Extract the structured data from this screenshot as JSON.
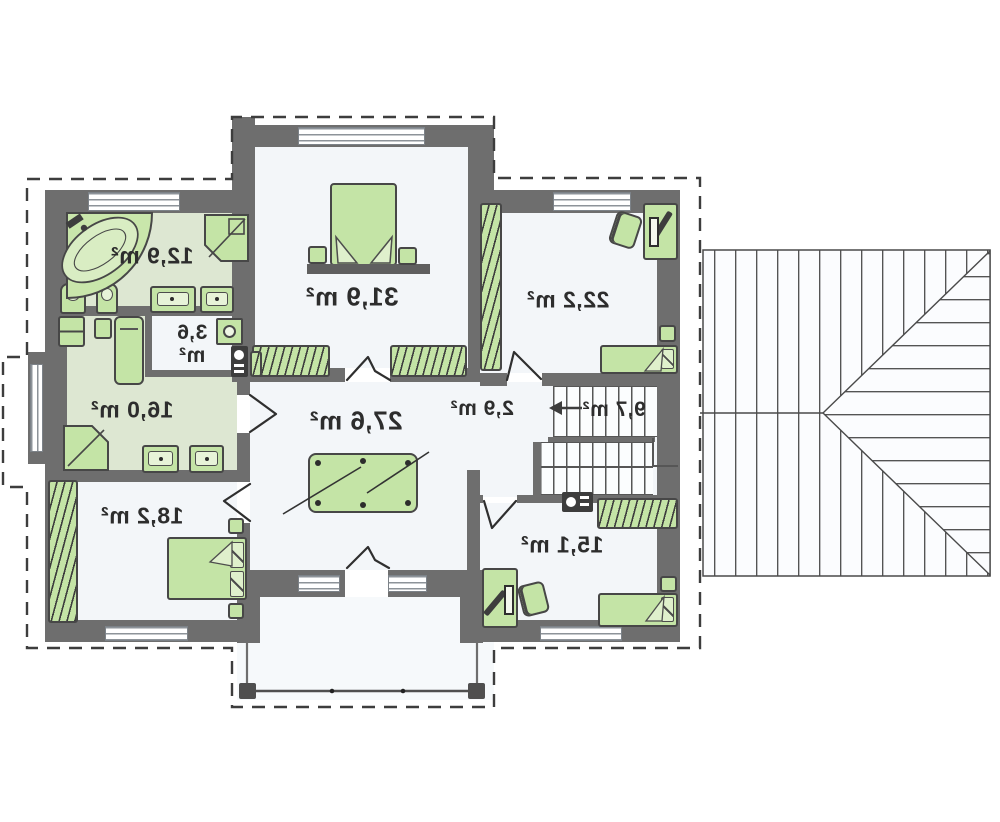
{
  "plan_type": "floor-plan-mirrored",
  "rooms": [
    {
      "id": "bathroom-top-left",
      "area": "12,9 m²"
    },
    {
      "id": "bedroom-master",
      "area": "31,9 m²"
    },
    {
      "id": "bedroom-top-right",
      "area": "22,2 m²"
    },
    {
      "id": "laundry",
      "area": "3,6 m²"
    },
    {
      "id": "wellness-room",
      "area": "16,0 m²"
    },
    {
      "id": "billiard-room",
      "area": "27,6 m²"
    },
    {
      "id": "corridor",
      "area": "2,9 m²"
    },
    {
      "id": "stair-hall",
      "area": "9,7 m²"
    },
    {
      "id": "bedroom-bottom-left",
      "area": "18,2 m²"
    },
    {
      "id": "bedroom-bottom-right",
      "area": "15,1 m²"
    }
  ],
  "colors": {
    "wall": "#6e6e6e",
    "floor": "#f3f6f9",
    "wet_room_floor": "#dde7d2",
    "furniture_green": "#c4e4a6",
    "outline_dashed": "#3d3d3d",
    "roof_line": "#4a4a4a"
  }
}
